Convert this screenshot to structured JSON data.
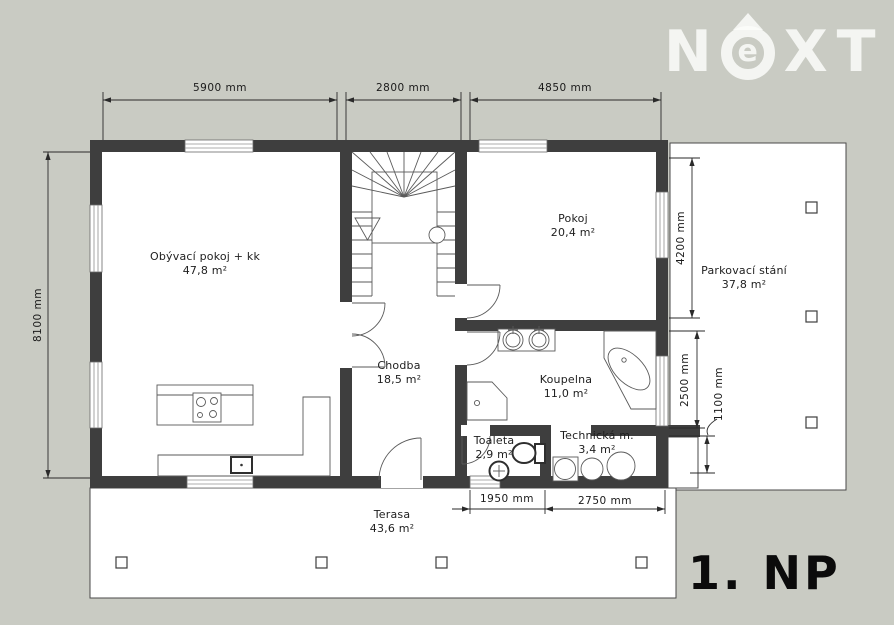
{
  "logo": {
    "n": "N",
    "e": "e",
    "x": "X",
    "t": "T"
  },
  "floor_label": "1. NP",
  "rooms": {
    "obyvaci": {
      "name": "Obývací pokoj + kk",
      "area": "47,8 m²"
    },
    "pokoj": {
      "name": "Pokoj",
      "area": "20,4 m²"
    },
    "chodba": {
      "name": "Chodba",
      "area": "18,5 m²"
    },
    "koupelna": {
      "name": "Koupelna",
      "area": "11,0 m²"
    },
    "toaleta": {
      "name": "Toaleta",
      "area": "2,9 m²"
    },
    "technicka": {
      "name": "Technická m.",
      "area": "3,4 m²"
    },
    "terasa": {
      "name": "Terasa",
      "area": "43,6 m²"
    },
    "parkovani": {
      "name": "Parkovací stání",
      "area": "37,8 m²"
    }
  },
  "dimensions": {
    "top_1": "5900 mm",
    "top_2": "2800 mm",
    "top_3": "4850 mm",
    "left_1": "8100 mm",
    "right_1": "4200 mm",
    "right_2": "2500 mm",
    "right_3": "1100 mm",
    "bottom_1": "1950 mm",
    "bottom_2": "2750 mm"
  },
  "colors": {
    "background": "#c9cbc3",
    "paper": "#ffffff",
    "wall": "#3e3e3e",
    "line": "#2a2a2a",
    "logo": "#f2f3f0"
  }
}
